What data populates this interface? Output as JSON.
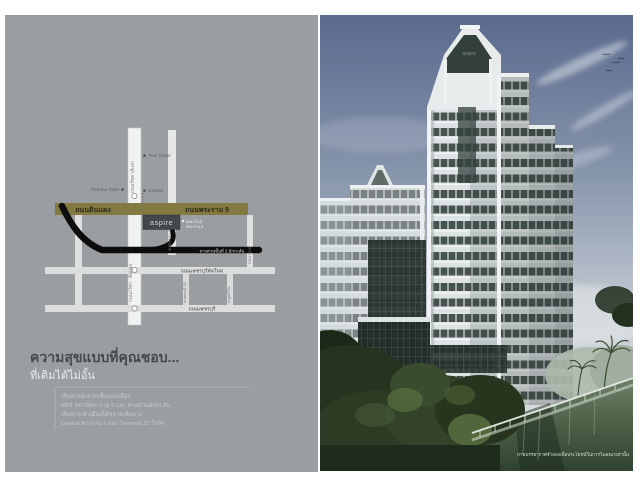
{
  "brand": {
    "badge": "aspire",
    "crown_logo": "aspire"
  },
  "left_panel": {
    "map": {
      "road_din_daeng": "ถนนดินแดง",
      "road_rama9": "ถนนพระราม 9",
      "road_ratchadaphisek": "ถนนรัชดาภิเษก",
      "road_asok_din_daeng": "ถนนอโศก - ดินแดง",
      "soi_rama9": "ซ.พระราม 9",
      "road_rca": "ถนน RCA",
      "expressway": "ทางด่วนขั้นที่ 2 มักกะสัน",
      "road_new_phetchaburi": "ถนนเพชรบุรีตัดใหม่",
      "road_phetchaburi": "ถนนเพชรบุรี",
      "soi_phetchaburi35": "ซ.เพชรบุรี 35",
      "soi_research": "ซ.ศูนย์วิจัย",
      "mrt_rama9": "พระราม 9",
      "landmark_fortune": "Fortune Town",
      "landmark_true": "True Tower",
      "landmark_central": "Central",
      "landmark_nine_1": "เดอะไนน์",
      "landmark_nine_2": "พระราม 9"
    },
    "headline": "ความสุขแบบที่คุณชอบ...",
    "subheadline": "ที่เติมได้ไม่อั้น",
    "body_lines": [
      "เดินทางสะดวกเชื่อมต่อเมือง",
      "MRT สถานีพระราม 9 และ ทางด่วนมักกะสัน",
      "เดินทางเข้าเมืองได้หลายเส้นทาง",
      "Central พระราม 9 และ Terminal 21 ใกล้ๆ"
    ]
  },
  "right_panel": {
    "caption": "ภาพบรรยากาศจำลองเพื่อประโยชน์ในการโฆษณาเท่านั้น"
  },
  "colors": {
    "panel_gray": "#9b9ea1",
    "road_gold": "#837a41",
    "expressway_black": "#0d0d0d",
    "sky_top": "#5a6a8e",
    "water_green": "#4c6147",
    "badge_bg": "#43474a"
  }
}
